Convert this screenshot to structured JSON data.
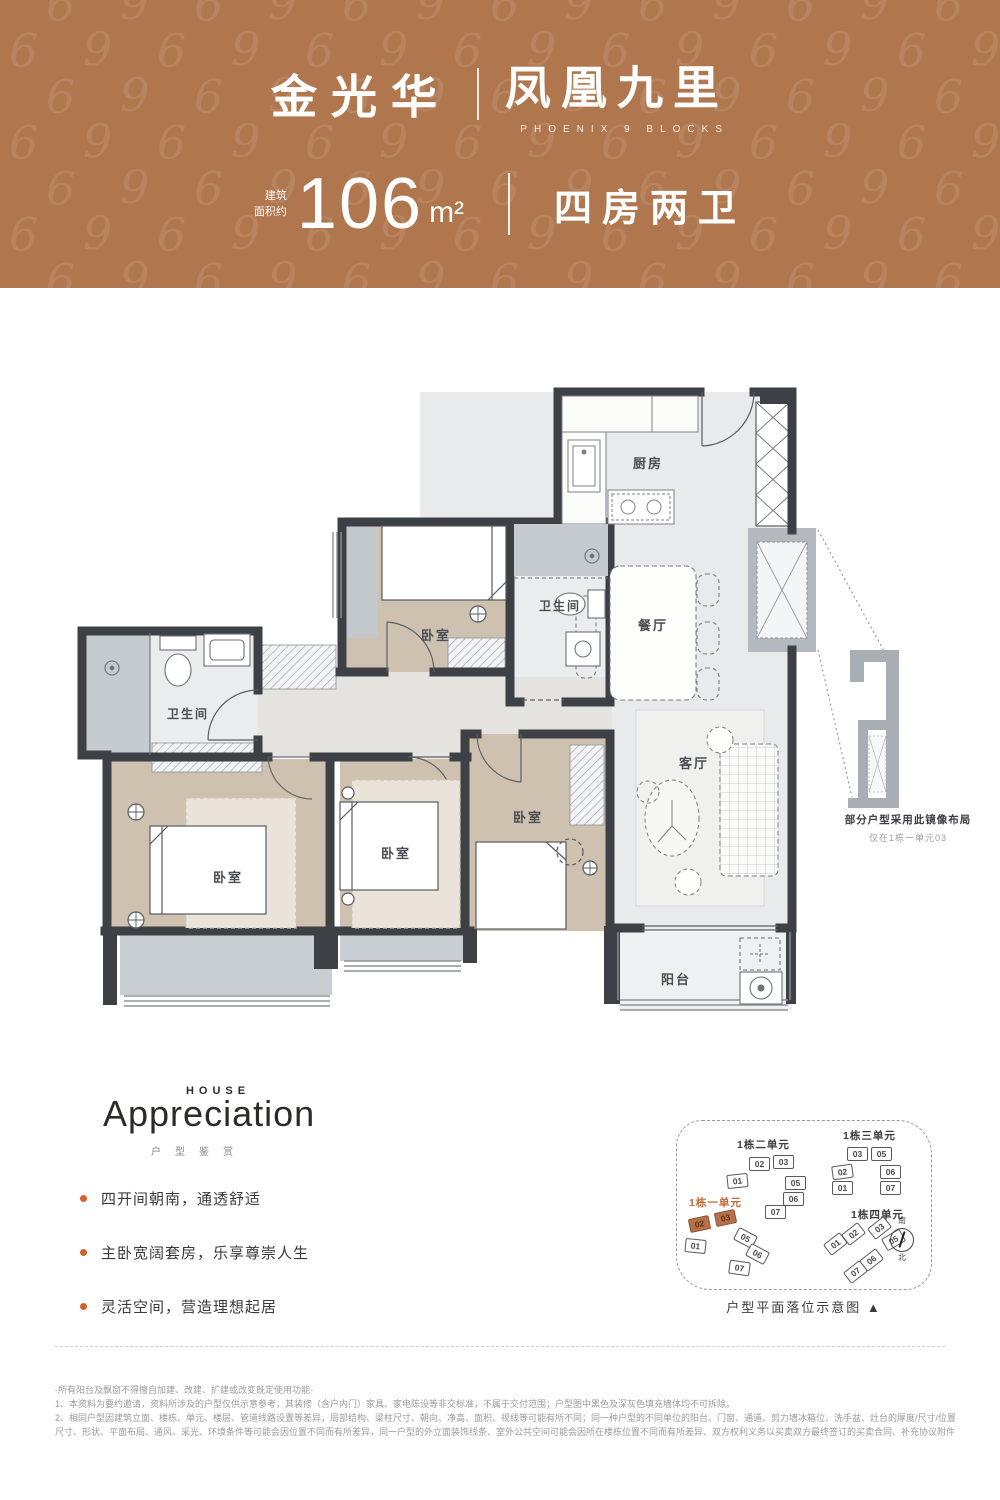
{
  "header": {
    "brand_left": "金光华",
    "brand_right": "凤凰九里",
    "brand_sub": "PHOENIX 9 BLOCKS",
    "area_prefix_line1": "建筑",
    "area_prefix_line2": "面积约",
    "area_value": "106",
    "area_unit": "m²",
    "layout_label": "四房两卫",
    "bg_color": "#b0774e"
  },
  "floorplan": {
    "labels": {
      "kitchen": "厨房",
      "dining": "餐厅",
      "living": "客厅",
      "balcony": "阳台",
      "bath": "卫生间",
      "bedroom": "卧室"
    },
    "mirror": {
      "title": "部分户型采用此镜像布局",
      "sub": "仅在1栋一单元03"
    }
  },
  "appreciation": {
    "eyebrow": "HOUSE",
    "title": "Appreciation",
    "subtitle": "户型鉴赏",
    "accent_color": "#d2622a",
    "bullets": [
      "四开间朝南，通透舒适",
      "主卧宽阔套房，乐享尊崇人生",
      "灵活空间，营造理想起居"
    ]
  },
  "siteplan": {
    "caption": "户型平面落位示意图 ▲",
    "compass_south": "南",
    "compass_north": "北",
    "clusters": [
      {
        "name": "1栋二单元",
        "accent": false,
        "label_x": 60,
        "label_y": 16,
        "units": [
          {
            "n": "02",
            "x": 72,
            "y": 36,
            "r": 0,
            "hl": false
          },
          {
            "n": "03",
            "x": 96,
            "y": 34,
            "r": 0,
            "hl": false
          },
          {
            "n": "01",
            "x": 50,
            "y": 53,
            "r": -6,
            "hl": false
          },
          {
            "n": "05",
            "x": 108,
            "y": 55,
            "r": 0,
            "hl": false
          },
          {
            "n": "06",
            "x": 106,
            "y": 71,
            "r": 0,
            "hl": false
          },
          {
            "n": "07",
            "x": 88,
            "y": 84,
            "r": 0,
            "hl": false
          }
        ]
      },
      {
        "name": "1栋三单元",
        "accent": false,
        "label_x": 166,
        "label_y": 7,
        "units": [
          {
            "n": "03",
            "x": 170,
            "y": 26,
            "r": 0,
            "hl": false
          },
          {
            "n": "05",
            "x": 194,
            "y": 26,
            "r": 0,
            "hl": false
          },
          {
            "n": "02",
            "x": 155,
            "y": 44,
            "r": -8,
            "hl": false
          },
          {
            "n": "01",
            "x": 155,
            "y": 60,
            "r": 0,
            "hl": false
          },
          {
            "n": "06",
            "x": 203,
            "y": 44,
            "r": 0,
            "hl": false
          },
          {
            "n": "07",
            "x": 203,
            "y": 60,
            "r": 0,
            "hl": false
          }
        ]
      },
      {
        "name": "1栋一单元",
        "accent": true,
        "label_x": 12,
        "label_y": 74,
        "units": [
          {
            "n": "02",
            "x": 12,
            "y": 96,
            "r": -12,
            "hl": true
          },
          {
            "n": "03",
            "x": 38,
            "y": 90,
            "r": -12,
            "hl": true
          },
          {
            "n": "01",
            "x": 8,
            "y": 118,
            "r": 6,
            "hl": false
          },
          {
            "n": "05",
            "x": 58,
            "y": 110,
            "r": 28,
            "hl": false
          },
          {
            "n": "06",
            "x": 70,
            "y": 126,
            "r": 28,
            "hl": false
          },
          {
            "n": "07",
            "x": 52,
            "y": 140,
            "r": 8,
            "hl": false
          }
        ]
      },
      {
        "name": "1栋四单元",
        "accent": false,
        "label_x": 174,
        "label_y": 86,
        "units": [
          {
            "n": "01",
            "x": 148,
            "y": 116,
            "r": -38,
            "hl": false
          },
          {
            "n": "02",
            "x": 166,
            "y": 106,
            "r": -38,
            "hl": false
          },
          {
            "n": "03",
            "x": 192,
            "y": 100,
            "r": -38,
            "hl": false
          },
          {
            "n": "05",
            "x": 206,
            "y": 112,
            "r": -30,
            "hl": false
          },
          {
            "n": "06",
            "x": 184,
            "y": 132,
            "r": -38,
            "hl": false
          },
          {
            "n": "07",
            "x": 168,
            "y": 144,
            "r": -38,
            "hl": false
          }
        ]
      }
    ]
  },
  "disclaimer": {
    "lines": [
      "-所有阳台及飘窗不得擅自加建、改建、扩建或改变既定使用功能-",
      "1、本资料为要约邀请，资料所涉及的户型仅供示意参考，其装修（含户内门）家具、家电陈设等非交标准，不属于交付范围；户型图中黑色及深灰色填充墙体均不可拆除。",
      "2、相同户型因建筑立面、楼栋、单元、楼层、管道线路设置等差异，局部结构、梁柱尺寸、朝向、净高、面积、视线等可能有所不同；同一种户型的不同单位的阳台、门窗、通道、剪力墙冰箱位、洗手盆、灶台的厚度/尺寸/位置等可能不同、每一单位的结构面积、",
      "尺寸、形状、平面布局、通风、采光、环境条件等可能会因位置不同而有所差异，同一户型的外立面装饰线条、室外公共空间可能会因所在楼栋位置不同而有所差异、双方权利义务以买卖双方最终签订的买卖合同、补充协议附件等书面文件及实际交付为准。"
    ]
  }
}
